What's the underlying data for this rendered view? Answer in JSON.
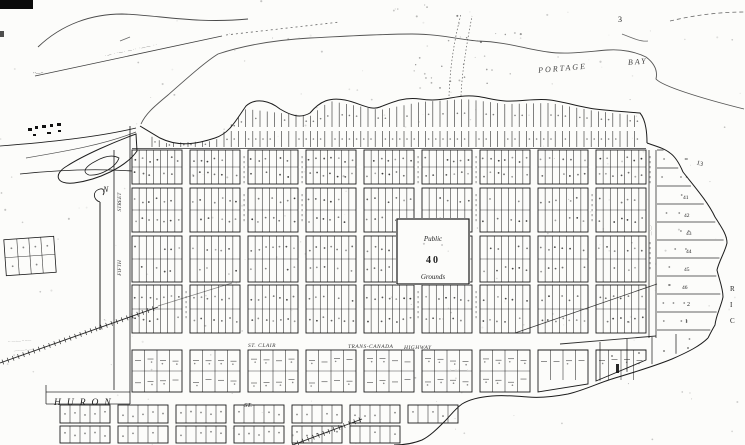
{
  "map": {
    "region_labels": {
      "portage": "PORTAGE",
      "bay": "BAY"
    },
    "streets": {
      "huron": "HURON",
      "huron_st_abbrev": "ST.",
      "st_clair": "ST. CLAIR",
      "trans_canada": "TRANS-CANADA",
      "highway": "HIGHWAY",
      "fifth": "FIFTH",
      "fifth_street_word": "STREET"
    },
    "public_square": {
      "line1": "Public",
      "line2": "40",
      "line3": "Grounds"
    },
    "north_arrow_label": "N",
    "block_numbers": {
      "top_right": "3",
      "east_13": "13",
      "east_strip": [
        "41",
        "42",
        "43",
        "44",
        "45",
        "46"
      ],
      "east_lower": [
        "2",
        "1"
      ],
      "shore_letters_vertical": [
        "R",
        "I",
        "C"
      ]
    },
    "illegible_notes": {
      "survey_line": "·— ··—· —·· ·—— ··",
      "west_margin": "··—··",
      "railway_1": "·· —·— ····—",
      "railway_2": "—··—·· —·",
      "east_street": "—·—·",
      "south_1": "·—·· · ——·"
    }
  }
}
